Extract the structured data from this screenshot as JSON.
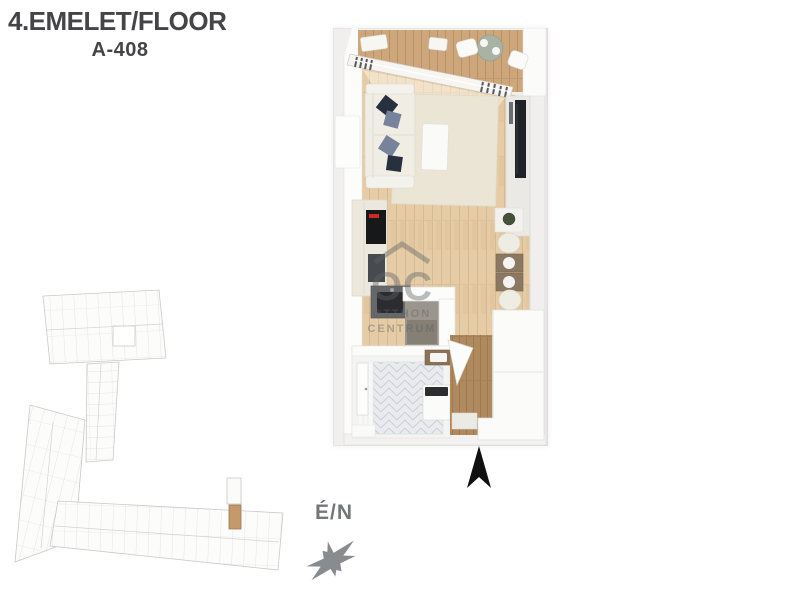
{
  "header": {
    "floor_label": "4.EMELET/FLOOR",
    "unit_label": "A-408"
  },
  "compass": {
    "label": "É/N"
  },
  "watermark": {
    "logo_text": "OC",
    "line1": "OTTHON",
    "line2": "CENTRUM"
  },
  "colors": {
    "header_text": "#454548",
    "compass_text": "#74777a",
    "north_arrow": "#101010",
    "highlight_unit": "#c49a6c",
    "rug": "#ebe5d6",
    "pillow_navy": "#27303f",
    "pillow_gray": "#77839a",
    "balcony_table_sage": "#a9b3a4",
    "wood_floor": "#e5cca6",
    "balcony_deck": "#cda67b"
  }
}
